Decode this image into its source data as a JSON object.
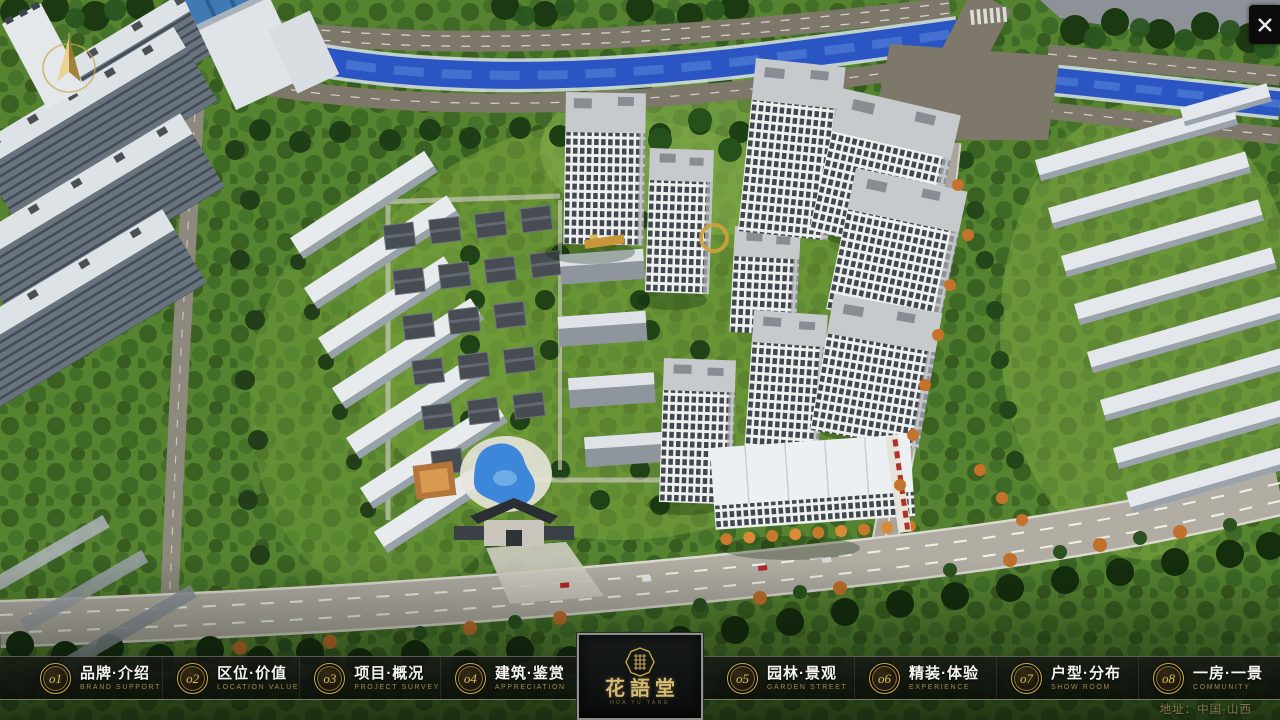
{
  "scene": {
    "description": "aerial-masterplan-render"
  },
  "controls": {
    "close": "✕"
  },
  "logo": {
    "title": "花語堂",
    "subtitle": "HUA YU TANG"
  },
  "address": "地址：中国·山西",
  "nav": {
    "items": [
      {
        "num": "o1",
        "label": "品牌·介绍",
        "en": "BRAND SUPPORT"
      },
      {
        "num": "o2",
        "label": "区位·价值",
        "en": "LOCATION VALUE"
      },
      {
        "num": "o3",
        "label": "项目·概况",
        "en": "PROJECT SURVEY"
      },
      {
        "num": "o4",
        "label": "建筑·鉴赏",
        "en": "APPRECIATION"
      },
      {
        "num": "o5",
        "label": "园林·景观",
        "en": "GARDEN STREET"
      },
      {
        "num": "o6",
        "label": "精装·体验",
        "en": "EXPERIENCE"
      },
      {
        "num": "o7",
        "label": "户型·分布",
        "en": "SHOW ROOM"
      },
      {
        "num": "o8",
        "label": "一房·一景",
        "en": "COMMUNITY"
      }
    ]
  },
  "colors": {
    "gold": "#c9a84c",
    "navText": "#f4f4f1",
    "navEn": "#9d8a50",
    "river": "#2a55c2"
  }
}
